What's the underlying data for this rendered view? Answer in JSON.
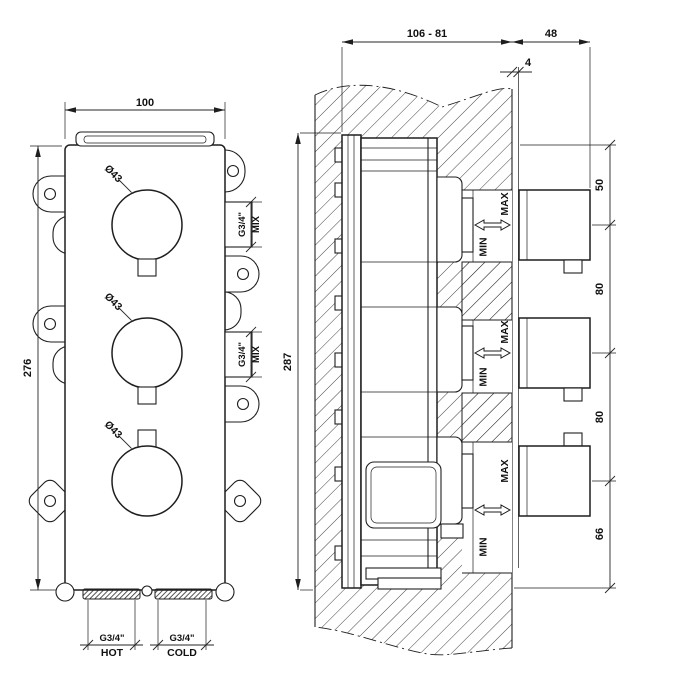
{
  "meta": {
    "background": "#ffffff",
    "line_color": "#1e1e1e",
    "drawing_type": "thermostatic mixer rough-in technical drawing"
  },
  "front_view": {
    "width_dim": "100",
    "height_dim": "276",
    "diameter_labels": [
      "Ø43",
      "Ø43",
      "Ø43"
    ],
    "mix_ports": [
      {
        "size": "G3/4\"",
        "name": "MIX"
      },
      {
        "size": "G3/4\"",
        "name": "MIX"
      }
    ],
    "inlet_ports": [
      {
        "size": "G3/4\"",
        "name": "HOT"
      },
      {
        "size": "G3/4\"",
        "name": "COLD"
      }
    ]
  },
  "side_view": {
    "depth_dim": "106 - 81",
    "knob_depth_dim": "48",
    "finish_gap_dim": "4",
    "height_dim": "287",
    "spacing_dims": [
      "50",
      "80",
      "80",
      "66"
    ],
    "range_labels": [
      {
        "min": "MIN",
        "max": "MAX"
      },
      {
        "min": "MIN",
        "max": "MAX"
      },
      {
        "min": "MIN",
        "max": "MAX"
      }
    ]
  }
}
